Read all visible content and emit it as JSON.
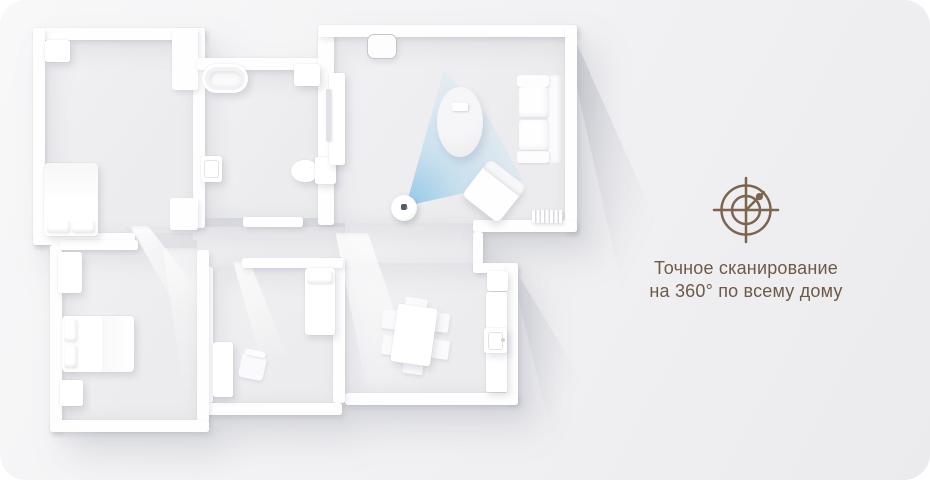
{
  "feature": {
    "icon": "radar-360-scan-icon",
    "caption_line1": "Точное сканирование",
    "caption_line2": "на 360° по всему дому",
    "accent_color": "#6d5947"
  },
  "floorplan": {
    "device": "robot-vacuum",
    "beam_color": "#bfe0f2",
    "rooms": [
      "bedroom-1",
      "bathroom",
      "living-room",
      "bedroom-2",
      "kids-room",
      "kitchen-dining",
      "hallway"
    ],
    "furniture": [
      "dresser",
      "double-bed",
      "bathtub",
      "washing-machine",
      "toilet",
      "bath-cabinet",
      "tv-console",
      "air-purifier",
      "coffee-table",
      "remote",
      "sofa",
      "armchair",
      "radiator",
      "robot-vacuum",
      "wardrobe",
      "bed",
      "nightstand",
      "single-bed",
      "desk-chair",
      "cabinet",
      "dining-table",
      "dining-chairs",
      "kitchen-counter",
      "sink",
      "kitchen-cabinet"
    ]
  },
  "colors": {
    "canvas_bg": "#f1f1f3",
    "wall": "#fefefe",
    "floor": "#ededef"
  }
}
